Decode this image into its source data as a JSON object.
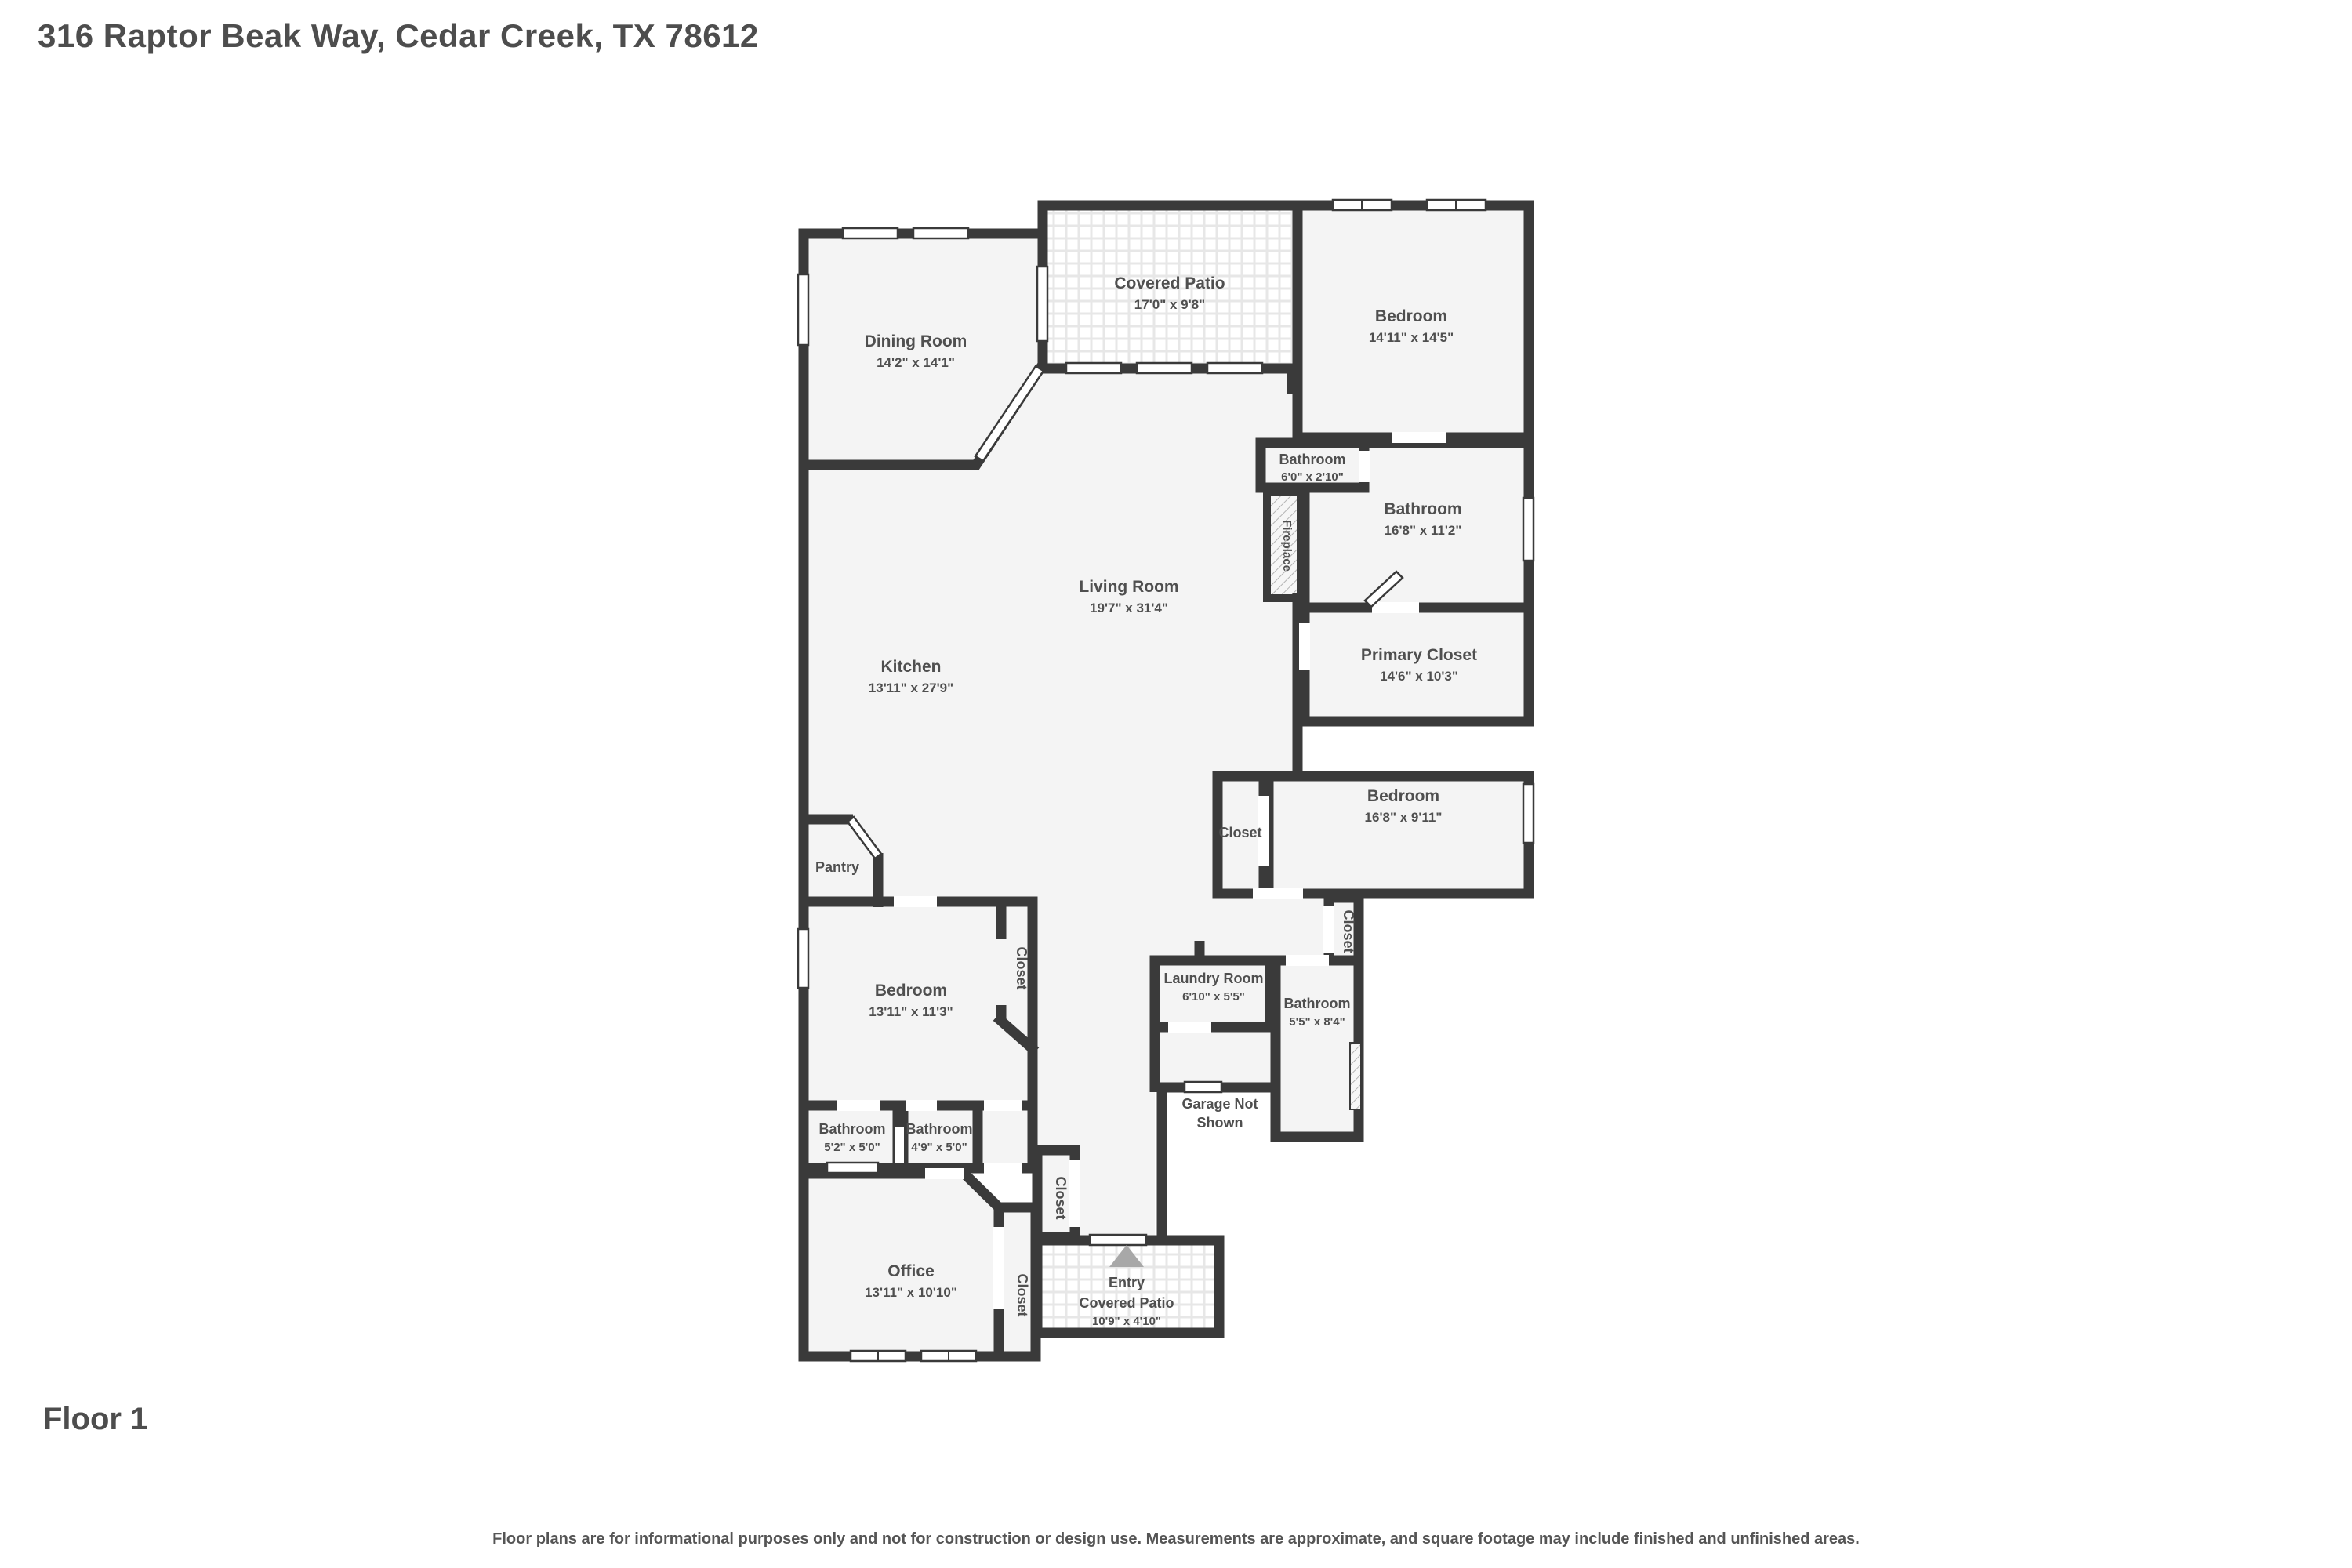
{
  "header": {
    "title": "316 Raptor Beak Way, Cedar Creek, TX 78612"
  },
  "floor": {
    "label": "Floor 1"
  },
  "disclaimer": "Floor plans are for informational purposes only and not for construction or design use. Measurements are approximate, and square footage may include finished and unfinished areas.",
  "colors": {
    "wall": "#3a3a3a",
    "room_fill": "#f4f4f4",
    "text": "#4f4f4f",
    "entry_arrow": "#a8a8a8"
  },
  "rooms": [
    {
      "id": "dining-room",
      "name": "Dining Room",
      "dims": "14'2\" x 14'1\""
    },
    {
      "id": "covered-patio",
      "name": "Covered Patio",
      "dims": "17'0\" x 9'8\""
    },
    {
      "id": "bedroom-top",
      "name": "Bedroom",
      "dims": "14'11\" x 14'5\""
    },
    {
      "id": "bathroom-small",
      "name": "Bathroom",
      "dims": "6'0\" x 2'10\""
    },
    {
      "id": "bathroom-primary",
      "name": "Bathroom",
      "dims": "16'8\" x 11'2\""
    },
    {
      "id": "primary-closet",
      "name": "Primary Closet",
      "dims": "14'6\" x 10'3\""
    },
    {
      "id": "living-room",
      "name": "Living Room",
      "dims": "19'7\" x 31'4\""
    },
    {
      "id": "kitchen",
      "name": "Kitchen",
      "dims": "13'11\" x 27'9\""
    },
    {
      "id": "fireplace",
      "name": "Fireplace"
    },
    {
      "id": "closet-mid",
      "name": "Closet"
    },
    {
      "id": "bedroom-mid",
      "name": "Bedroom",
      "dims": "16'8\" x 9'11\""
    },
    {
      "id": "closet-hall",
      "name": "Closet"
    },
    {
      "id": "pantry",
      "name": "Pantry"
    },
    {
      "id": "bedroom-lower",
      "name": "Bedroom",
      "dims": "13'11\" x 11'3\""
    },
    {
      "id": "closet-bedroom",
      "name": "Closet"
    },
    {
      "id": "laundry-room",
      "name": "Laundry Room",
      "dims": "6'10\" x 5'5\""
    },
    {
      "id": "bathroom-hall",
      "name": "Bathroom",
      "dims": "5'5\" x 8'4\""
    },
    {
      "id": "bathroom-a",
      "name": "Bathroom",
      "dims": "5'2\" x 5'0\""
    },
    {
      "id": "bathroom-b",
      "name": "Bathroom",
      "dims": "4'9\" x 5'0\""
    },
    {
      "id": "garage-note",
      "name_line1": "Garage Not",
      "name_line2": "Shown"
    },
    {
      "id": "closet-entry",
      "name": "Closet"
    },
    {
      "id": "office",
      "name": "Office",
      "dims": "13'11\" x 10'10\""
    },
    {
      "id": "closet-office",
      "name": "Closet"
    },
    {
      "id": "entry",
      "name": "Entry",
      "name2": "Covered Patio",
      "dims": "10'9\" x 4'10\""
    }
  ]
}
